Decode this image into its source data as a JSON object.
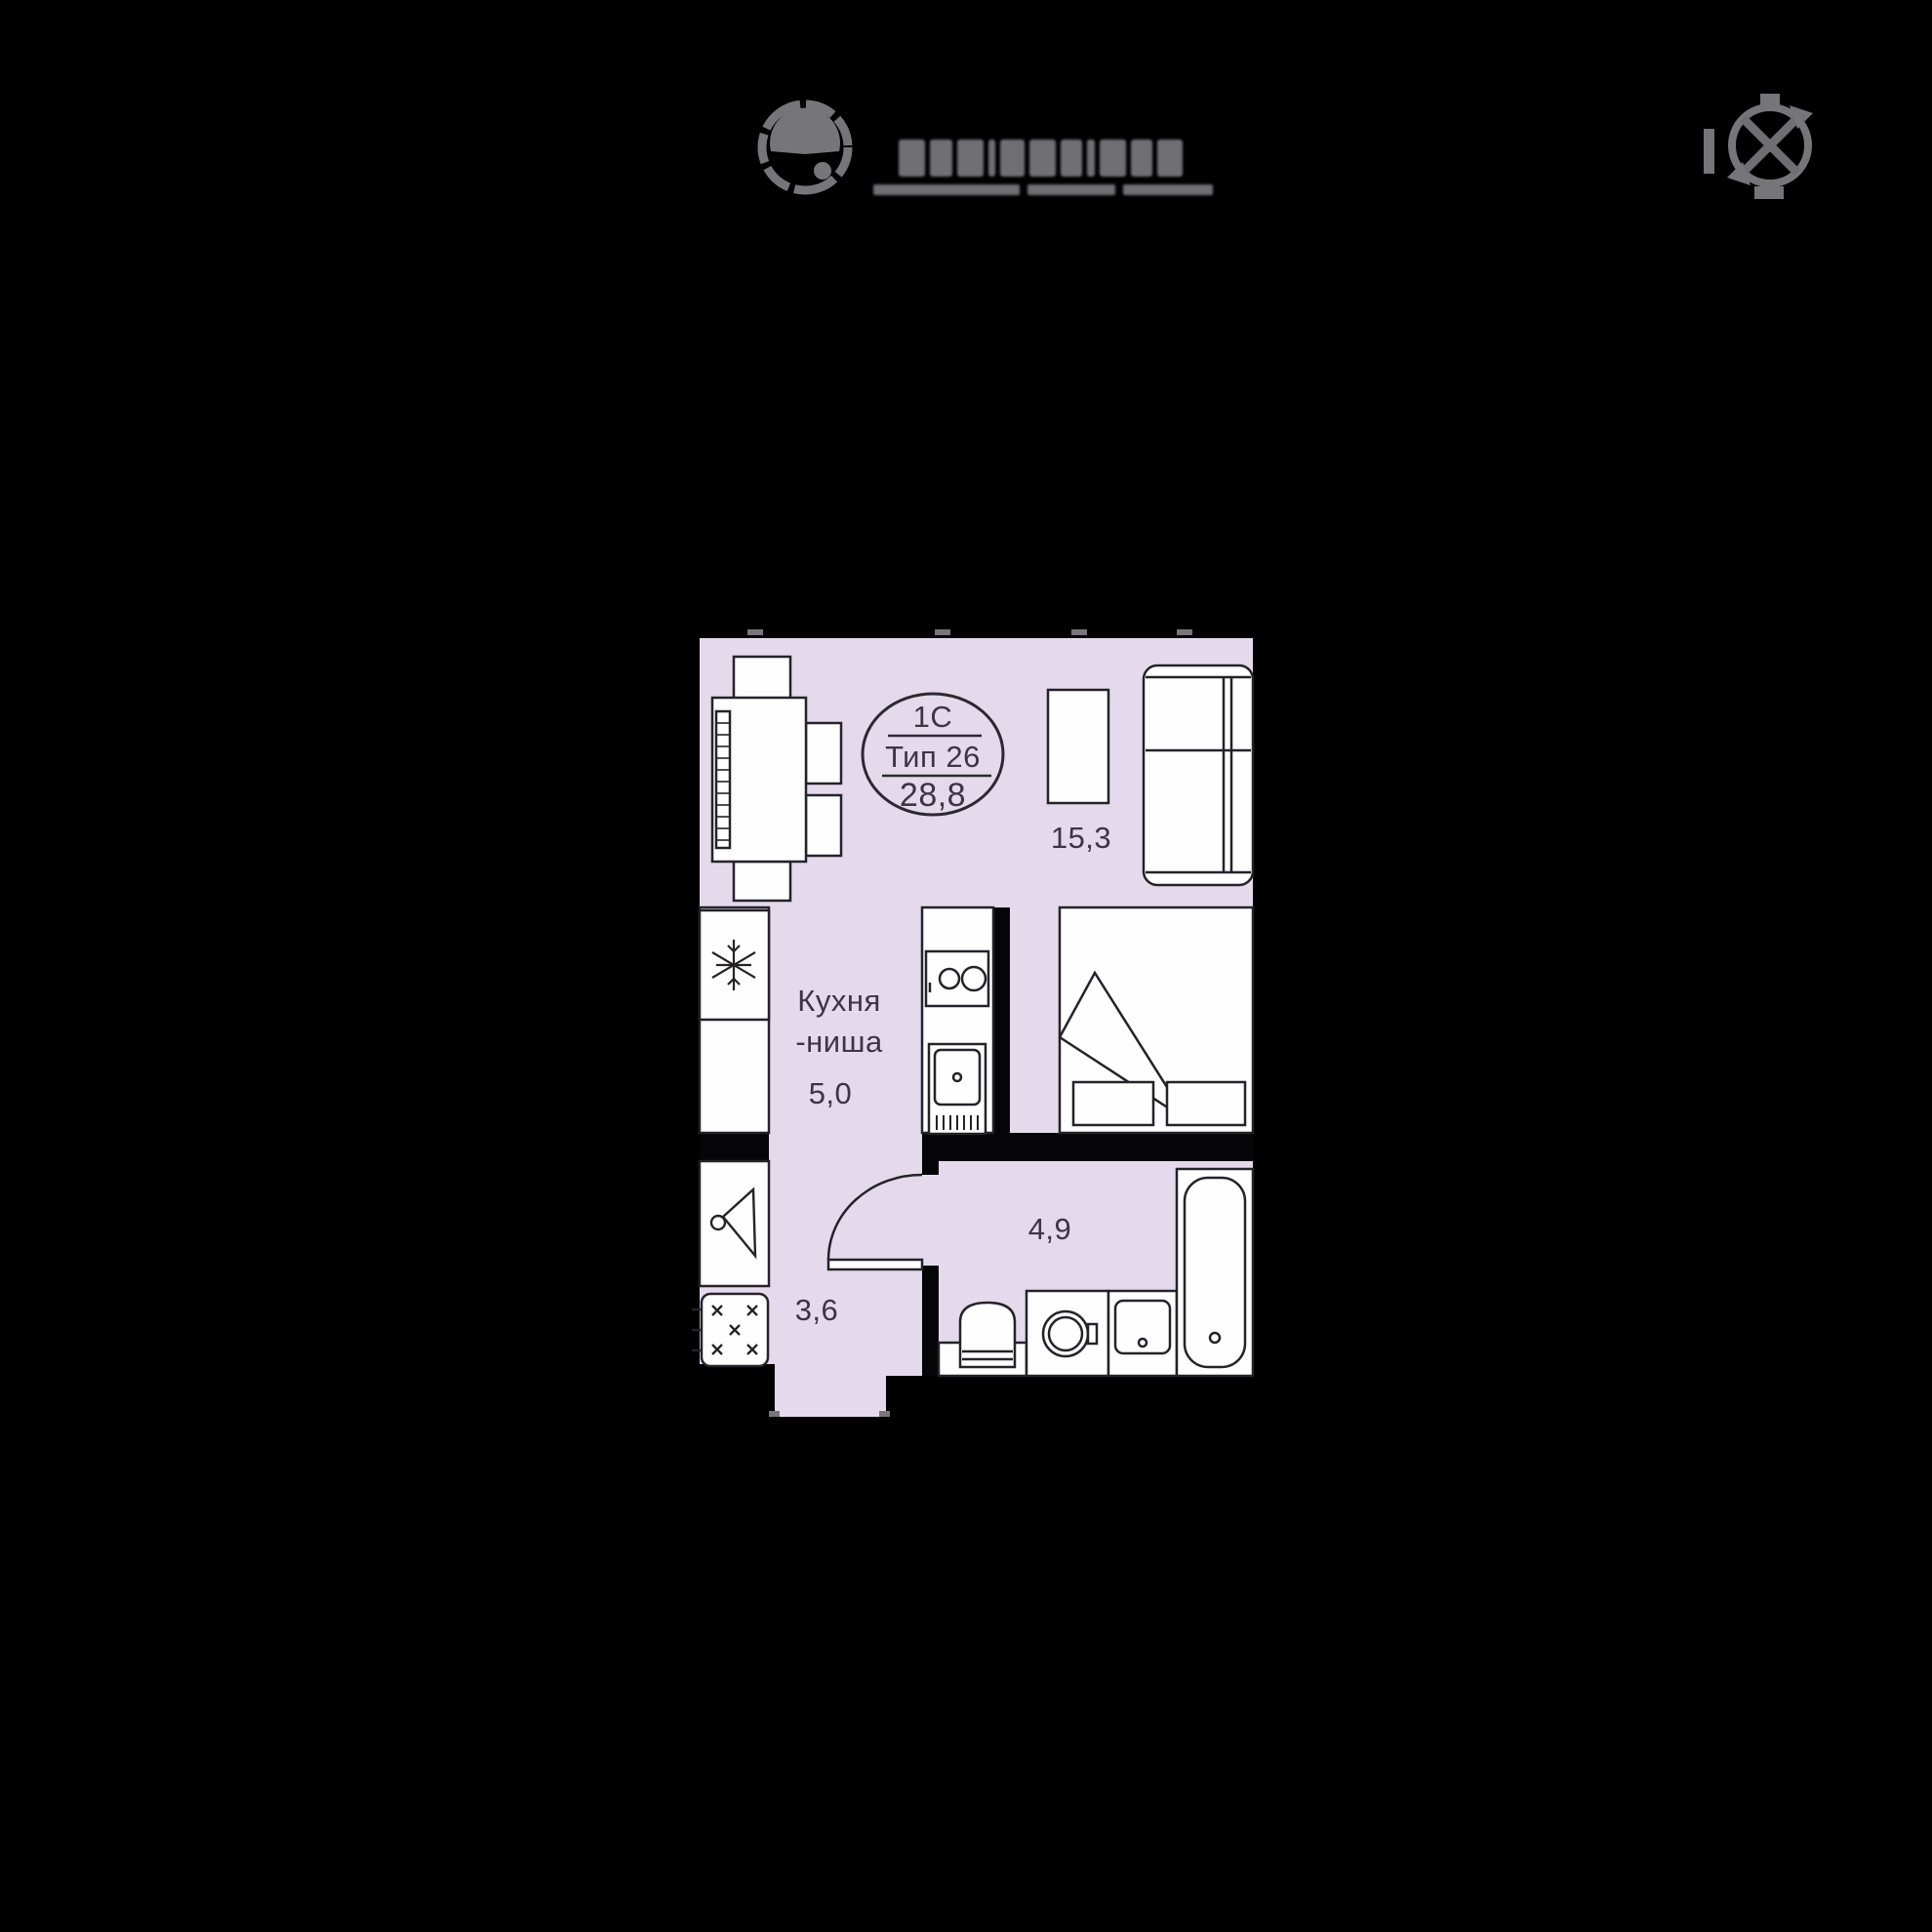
{
  "header": {
    "brand": {
      "emblem_icon": "brand-emblem-icon",
      "wordmark_legible": false
    },
    "compass_icon": "compass-rose-icon"
  },
  "plan": {
    "stamp": {
      "line1": "1С",
      "line2": "Тип 26",
      "line3": "28,8"
    },
    "rooms": {
      "living": {
        "area": "15,3"
      },
      "kitchen": {
        "name_line1": "Кухня",
        "name_line2": "-ниша",
        "area": "5,0"
      },
      "hall": {
        "area": "3,6"
      },
      "bath": {
        "area": "4,9"
      }
    },
    "colors": {
      "floor_fill": "#e4daeb",
      "furniture_fill": "#fefefe",
      "line": "#25222a",
      "wall": "#050507",
      "gray_mark": "#77767a",
      "background": "#000000"
    }
  }
}
